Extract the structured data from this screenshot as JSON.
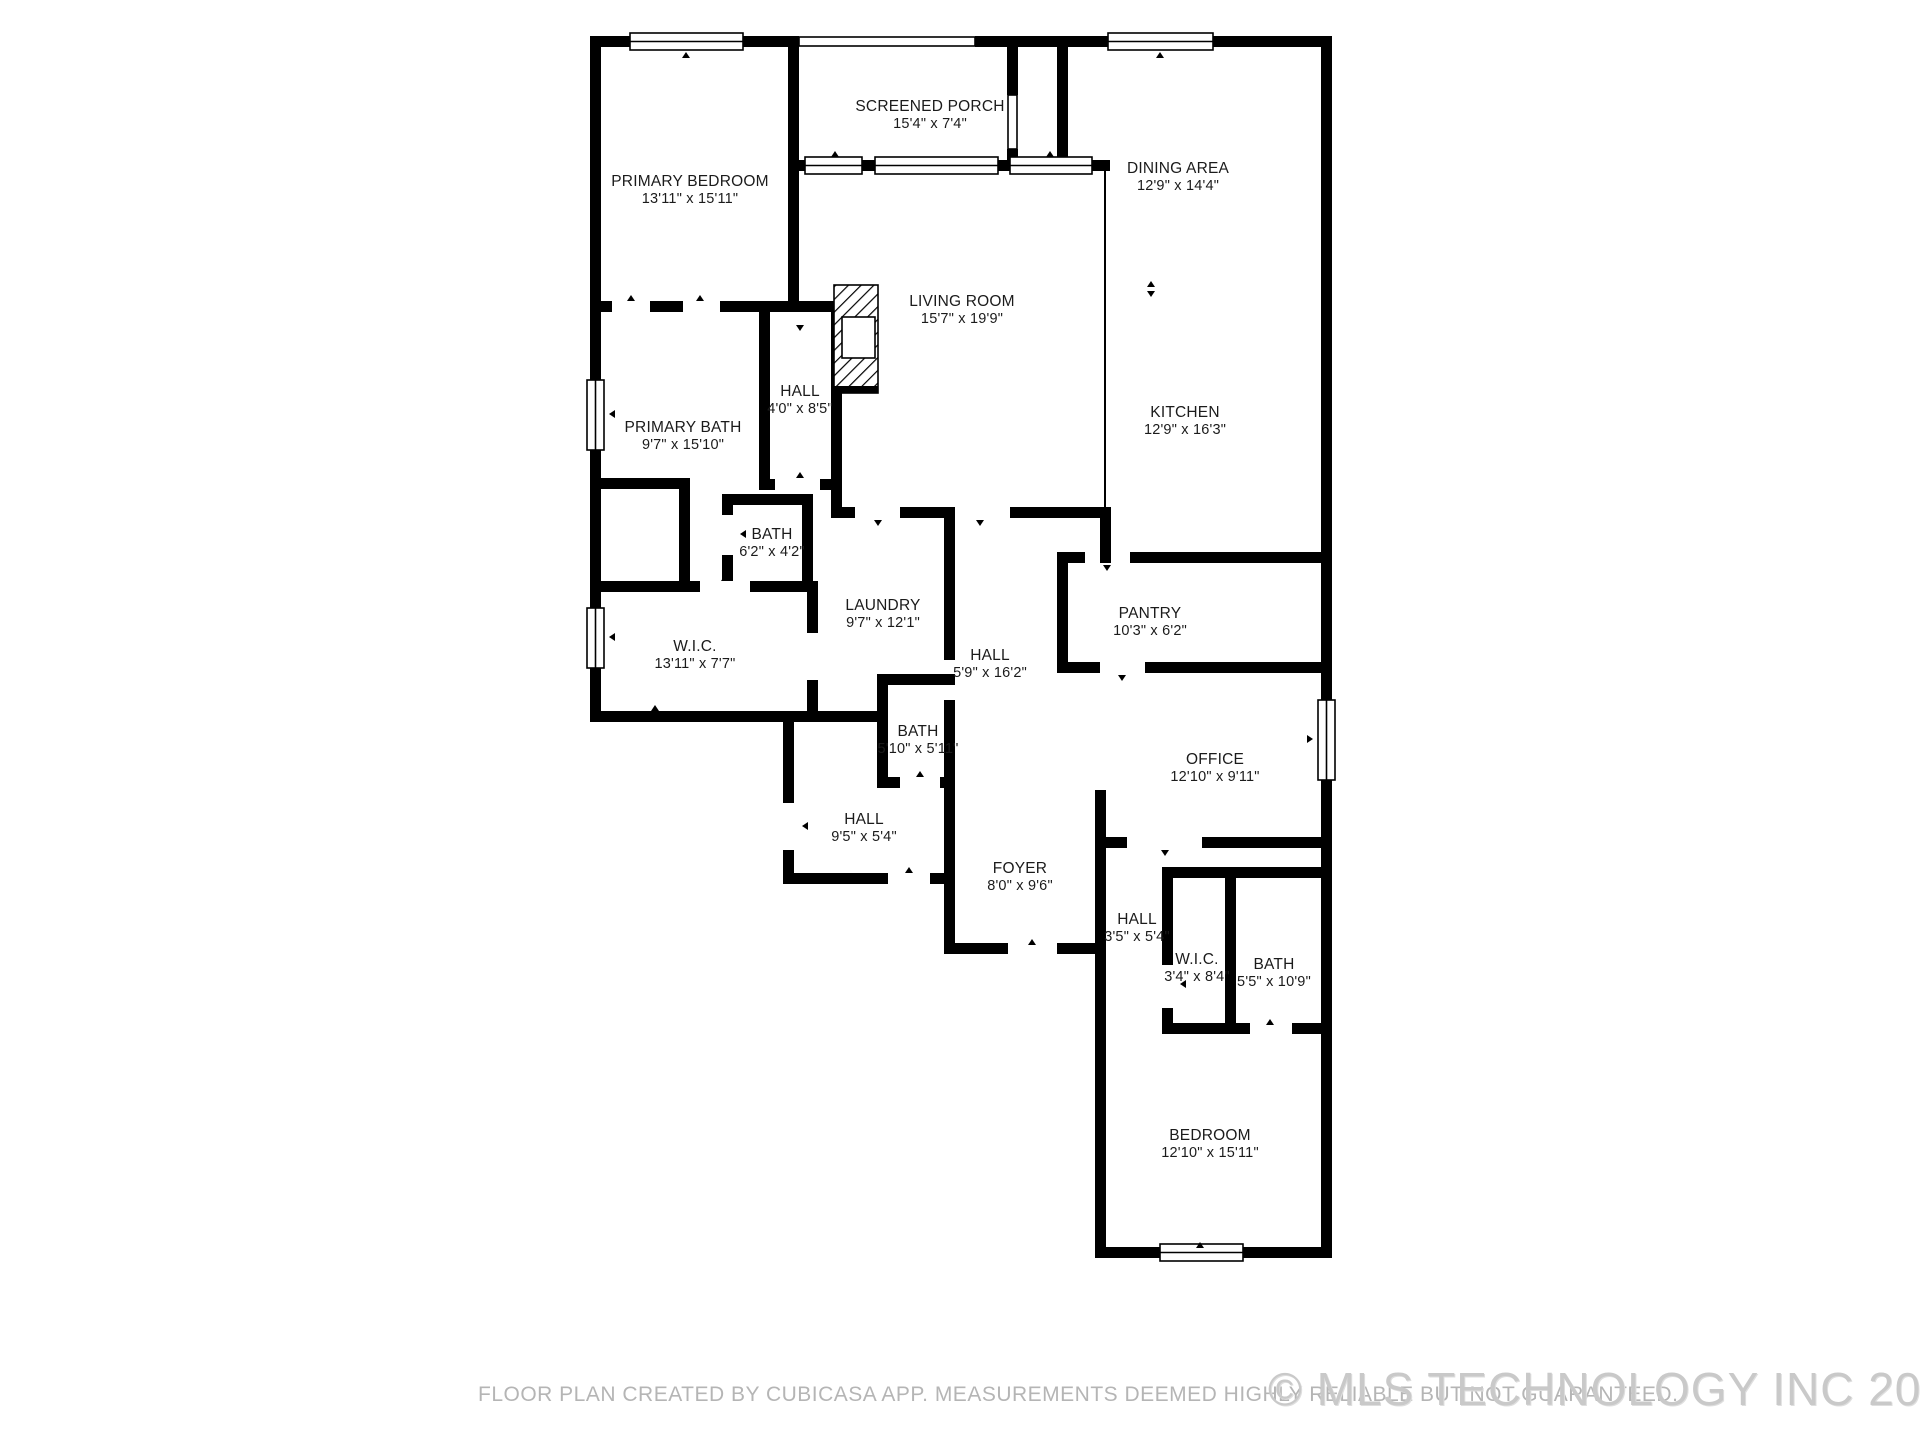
{
  "title": "Floor plan",
  "colors": {
    "wall": "#000000",
    "label_text": "#1b1b1b",
    "disclaimer_text": "#b5b5b5",
    "watermark_text": "#c9c9c9",
    "background": "#ffffff"
  },
  "rooms": [
    {
      "name": "PRIMARY BEDROOM",
      "dims": "13'11\" x 15'11\"",
      "x": 690,
      "y": 190
    },
    {
      "name": "SCREENED PORCH",
      "dims": "15'4\" x 7'4\"",
      "x": 930,
      "y": 115
    },
    {
      "name": "DINING AREA",
      "dims": "12'9\" x 14'4\"",
      "x": 1178,
      "y": 177
    },
    {
      "name": "LIVING ROOM",
      "dims": "15'7\" x 19'9\"",
      "x": 962,
      "y": 310
    },
    {
      "name": "KITCHEN",
      "dims": "12'9\" x 16'3\"",
      "x": 1185,
      "y": 421
    },
    {
      "name": "HALL",
      "dims": "4'0\" x 8'5\"",
      "x": 800,
      "y": 400
    },
    {
      "name": "PRIMARY BATH",
      "dims": "9'7\" x 15'10\"",
      "x": 683,
      "y": 436
    },
    {
      "name": "BATH",
      "dims": "6'2\" x 4'2\"",
      "x": 772,
      "y": 543
    },
    {
      "name": "W.I.C.",
      "dims": "13'11\" x 7'7\"",
      "x": 695,
      "y": 655
    },
    {
      "name": "LAUNDRY",
      "dims": "9'7\" x 12'1\"",
      "x": 883,
      "y": 614
    },
    {
      "name": "PANTRY",
      "dims": "10'3\" x 6'2\"",
      "x": 1150,
      "y": 622
    },
    {
      "name": "HALL",
      "dims": "5'9\" x 16'2\"",
      "x": 990,
      "y": 664
    },
    {
      "name": "BATH",
      "dims": "5'10\" x 5'11\"",
      "x": 918,
      "y": 740
    },
    {
      "name": "OFFICE",
      "dims": "12'10\" x 9'11\"",
      "x": 1215,
      "y": 768
    },
    {
      "name": "HALL",
      "dims": "9'5\" x 5'4\"",
      "x": 864,
      "y": 828
    },
    {
      "name": "FOYER",
      "dims": "8'0\" x 9'6\"",
      "x": 1020,
      "y": 877
    },
    {
      "name": "HALL",
      "dims": "3'5\" x 5'4\"",
      "x": 1137,
      "y": 928
    },
    {
      "name": "W.I.C.",
      "dims": "3'4\" x 8'4\"",
      "x": 1197,
      "y": 968
    },
    {
      "name": "BATH",
      "dims": "5'5\" x 10'9\"",
      "x": 1274,
      "y": 973
    },
    {
      "name": "BEDROOM",
      "dims": "12'10\" x 15'11\"",
      "x": 1210,
      "y": 1144
    }
  ],
  "footer": {
    "disclaimer": "FLOOR PLAN CREATED BY CUBICASA APP. MEASUREMENTS DEEMED HIGHLY RELIABLE BUT NOT GUARANTEED.",
    "watermark": "© MLS TECHNOLOGY INC 2025"
  }
}
